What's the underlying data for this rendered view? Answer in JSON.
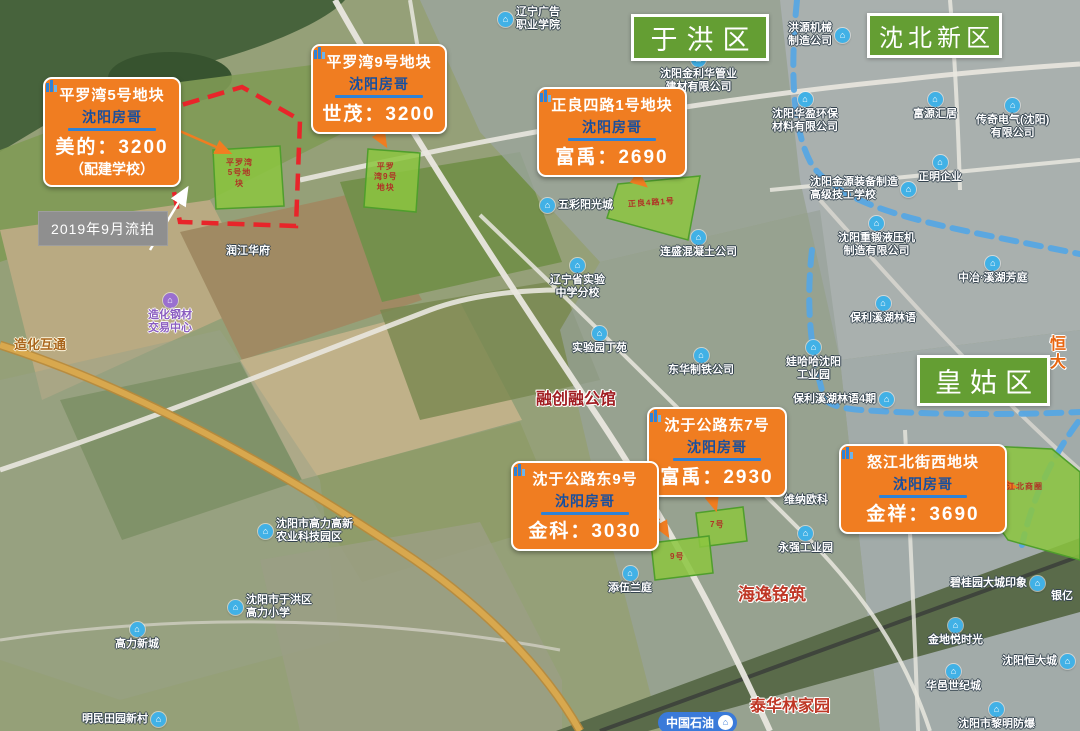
{
  "brand": {
    "name": "沈阳房哥"
  },
  "districts": [
    {
      "label": "于洪区"
    },
    {
      "label": "沈北新区"
    },
    {
      "label": "皇姑区"
    }
  ],
  "callouts": [
    {
      "title": "平罗湾5号地块",
      "price": "美的：3200",
      "note": "（配建学校）"
    },
    {
      "title": "平罗湾9号地块",
      "price": "世茂：3200"
    },
    {
      "title": "正良四路1号地块",
      "price": "富禹：2690"
    },
    {
      "title": "沈于公路东7号",
      "price": "富禹：2930"
    },
    {
      "title": "沈于公路东9号",
      "price": "金科：3030"
    },
    {
      "title": "怒江北街西地块",
      "price": "金祥：3690"
    }
  ],
  "note_box": {
    "text": "2019年9月流拍"
  },
  "parcel_labels": [
    {
      "text": "平罗湾\n5号地\n块"
    },
    {
      "text": "平罗\n湾9号\n地块"
    },
    {
      "text": "正良4路1号"
    },
    {
      "text": "7号"
    },
    {
      "text": "9号"
    },
    {
      "text": "怒江北商圈"
    }
  ],
  "pois": [
    {
      "name": "辽宁广告\n职业学院"
    },
    {
      "name": "沈阳金利华管业\n建材有限公司"
    },
    {
      "name": "洪源机械\n制造公司"
    },
    {
      "name": "沈阳华盈环保\n材料有限公司"
    },
    {
      "name": "富源汇居"
    },
    {
      "name": "传奇电气(沈阳)\n有限公司"
    },
    {
      "name": "正明企业"
    },
    {
      "name": "沈阳金源装备制造\n高级技工学校"
    },
    {
      "name": "沈阳重锻液压机\n制造有限公司"
    },
    {
      "name": "中冶·溪湖芳庭"
    },
    {
      "name": "保利溪湖林语"
    },
    {
      "name": "娃哈哈沈阳\n工业园"
    },
    {
      "name": "保利·溪湖\n林语一期"
    },
    {
      "name": "保利溪湖林语4期"
    },
    {
      "name": "五彩阳光城"
    },
    {
      "name": "连盛混凝土公司"
    },
    {
      "name": "润江华府"
    },
    {
      "name": "辽宁省实验\n中学分校"
    },
    {
      "name": "实验园丁苑"
    },
    {
      "name": "东华制铁公司"
    },
    {
      "name": "造化钢材\n交易中心"
    },
    {
      "name": "沈阳市高力高新\n农业科技园区"
    },
    {
      "name": "沈阳市于洪区\n高力小学"
    },
    {
      "name": "高力新城"
    },
    {
      "name": "明民田园新村"
    },
    {
      "name": "添伍兰庭"
    },
    {
      "name": "维纳欧科"
    },
    {
      "name": "永强工业园"
    },
    {
      "name": "碧桂园大城印象"
    },
    {
      "name": "银亿"
    },
    {
      "name": "金地悦时光"
    },
    {
      "name": "沈阳恒大城"
    },
    {
      "name": "华邑世纪城"
    },
    {
      "name": "沈阳市黎明防爆"
    }
  ],
  "red_labels": [
    {
      "text": "融创融公馆"
    },
    {
      "text": "海逸铭筑"
    },
    {
      "text": "泰华林家园"
    },
    {
      "text": "恒大"
    }
  ],
  "road_labels": [
    {
      "text": "造化互通"
    }
  ],
  "gas_station": {
    "label": "中国石油"
  }
}
